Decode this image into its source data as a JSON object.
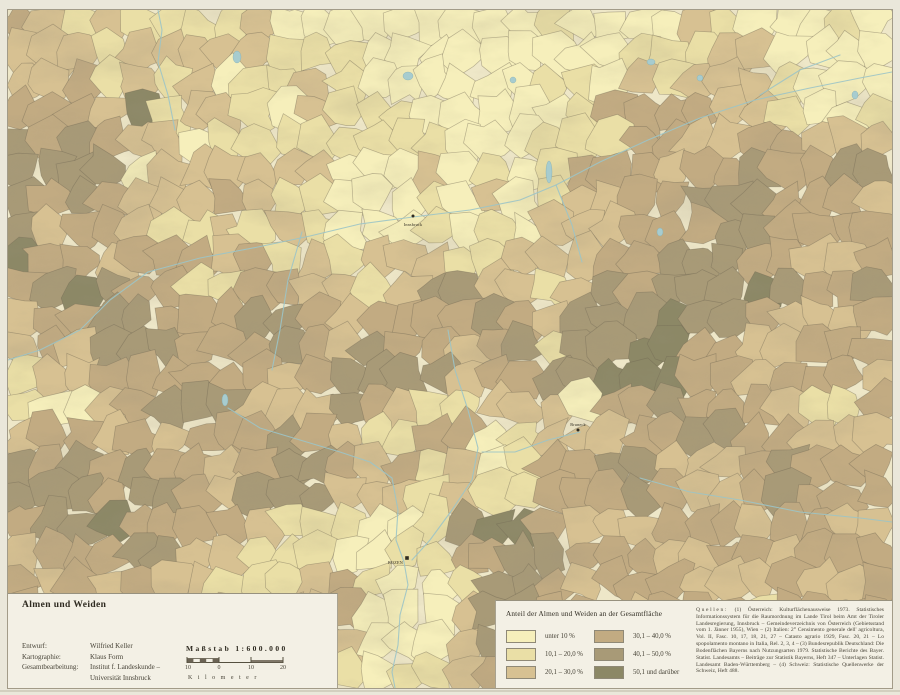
{
  "page": {
    "title": "Almen und Weiden"
  },
  "panel_left": {
    "title": "Almen und Weiden",
    "credits": [
      {
        "label": "Entwurf:",
        "value": "Wilfried Keller"
      },
      {
        "label": "Kartographie:",
        "value": "Klaus Form"
      },
      {
        "label": "Gesamtbearbeitung:",
        "value": "Institut f. Landeskunde –"
      },
      {
        "label": "",
        "value": "Universität Innsbruck"
      }
    ],
    "scale": {
      "label": "Maßstab 1:600.000",
      "ticks": [
        "10",
        "0",
        "10",
        "20"
      ],
      "unit": "Kilometer"
    }
  },
  "legend": {
    "title": "Anteil der Almen und Weiden an der Gesamtfläche",
    "classes": [
      {
        "label": "unter 10 %",
        "color": "#f6efbb"
      },
      {
        "label": "10,1 – 20,0 %",
        "color": "#eadfa6"
      },
      {
        "label": "20,1 – 30,0 %",
        "color": "#d7c192"
      },
      {
        "label": "30,1 – 40,0 %",
        "color": "#c2ab82"
      },
      {
        "label": "40,1 – 50,0 %",
        "color": "#a89a77"
      },
      {
        "label": "50,1 und darüber",
        "color": "#8c8866"
      }
    ]
  },
  "sources": {
    "heading": "Quellen:",
    "text": " (1) Österreich: Kulturflächenausweise 1973. Statistisches Informationssystem für die Raumordnung im Lande Tirol beim Amt der Tiroler Landesregierung, Innsbruck – Gemeindeverzeichnis von Österreich (Gebietsstand vom 1. Jänner 1955), Wien – (2) Italien: 2° Censimento generale dell' agricoltura, Vol. II, Fasc. 10, 17, 18, 21, 27 – Catasto agrario 1929, Fasc. 20, 21 – Lo spopolamento montano in Italia, Rel. 2, 3, 4 – (3) Bundesrepublik Deutschland: Die Bodenflächen Bayerns nach Nutzungsarten 1979. Statistische Berichte des Bayer. Statist. Landesamts – Beiträge zur Statistik Bayerns, Heft 347 – Unterlagen Statist. Landesamt Baden-Württemberg – (4) Schweiz: Statistische Quellenwerke der Schweiz, Heft 488."
  },
  "map": {
    "width": 884,
    "height": 678,
    "background": "#eee7c8",
    "border_color": "#6e6753",
    "river_color": "#9cc4c6",
    "lake_color": "#a7cccf",
    "seed": 42,
    "grid": {
      "cols": 30,
      "rows": 23
    },
    "class_raster": [
      "3232223111111111121111",
      "3323322221111112233111",
      "4436332222111124443212",
      "4443133222211224434433",
      "5541333211312234445445",
      "5443322211111234455444",
      "5434433323322334554434",
      "4554334333443234555445",
      "3455445434444345654334",
      "2344434465434456643443",
      "3234543354323414544324",
      "4433445432441334454433",
      "5545434543232445434544",
      "4554443321256433443433",
      "3445332211245444334344",
      "4434322341125434433443",
      "3443332331135433443344",
      "4344323221234344334434"
    ],
    "rivers": [
      {
        "name": "inn",
        "points": [
          [
            0,
            350
          ],
          [
            32,
            340
          ],
          [
            72,
            320
          ],
          [
            102,
            290
          ],
          [
            140,
            262
          ],
          [
            192,
            248
          ],
          [
            250,
            237
          ],
          [
            302,
            226
          ],
          [
            352,
            214
          ],
          [
            405,
            207
          ],
          [
            462,
            200
          ],
          [
            512,
            190
          ],
          [
            548,
            175
          ],
          [
            592,
            152
          ],
          [
            640,
            130
          ],
          [
            692,
            108
          ],
          [
            747,
            90
          ],
          [
            802,
            78
          ],
          [
            852,
            68
          ],
          [
            884,
            62
          ]
        ]
      },
      {
        "name": "lech",
        "points": [
          [
            167,
            120
          ],
          [
            160,
            85
          ],
          [
            150,
            52
          ],
          [
            154,
            20
          ],
          [
            150,
            0
          ]
        ]
      },
      {
        "name": "ziller",
        "points": [
          [
            548,
            175
          ],
          [
            564,
            215
          ],
          [
            574,
            252
          ]
        ]
      },
      {
        "name": "oetztaler-ache",
        "points": [
          [
            294,
            222
          ],
          [
            280,
            270
          ],
          [
            272,
            320
          ],
          [
            264,
            360
          ]
        ]
      },
      {
        "name": "etsch",
        "points": [
          [
            220,
            398
          ],
          [
            252,
            418
          ],
          [
            292,
            430
          ],
          [
            332,
            442
          ],
          [
            362,
            452
          ],
          [
            384,
            468
          ],
          [
            390,
            500
          ],
          [
            388,
            530
          ],
          [
            396,
            552
          ],
          [
            400,
            575
          ],
          [
            392,
            605
          ],
          [
            390,
            635
          ],
          [
            384,
            662
          ],
          [
            387,
            678
          ]
        ]
      },
      {
        "name": "eisack",
        "points": [
          [
            440,
            320
          ],
          [
            447,
            360
          ],
          [
            460,
            400
          ],
          [
            470,
            438
          ],
          [
            464,
            470
          ],
          [
            444,
            500
          ],
          [
            422,
            530
          ],
          [
            404,
            550
          ]
        ]
      },
      {
        "name": "rienz",
        "points": [
          [
            572,
            422
          ],
          [
            540,
            430
          ],
          [
            507,
            442
          ],
          [
            474,
            442
          ]
        ]
      },
      {
        "name": "drau",
        "points": [
          [
            632,
            468
          ],
          [
            682,
            482
          ],
          [
            732,
            490
          ],
          [
            792,
            502
          ],
          [
            852,
            508
          ],
          [
            884,
            512
          ]
        ]
      },
      {
        "name": "salzach",
        "points": [
          [
            752,
            85
          ],
          [
            792,
            60
          ],
          [
            832,
            45
          ]
        ]
      }
    ],
    "lakes": [
      {
        "cx": 229,
        "cy": 47,
        "rx": 4,
        "ry": 6
      },
      {
        "cx": 400,
        "cy": 66,
        "rx": 5,
        "ry": 4
      },
      {
        "cx": 505,
        "cy": 70,
        "rx": 3,
        "ry": 3
      },
      {
        "cx": 643,
        "cy": 52,
        "rx": 4,
        "ry": 3
      },
      {
        "cx": 692,
        "cy": 68,
        "rx": 3,
        "ry": 3
      },
      {
        "cx": 541,
        "cy": 162,
        "rx": 3,
        "ry": 11
      },
      {
        "cx": 652,
        "cy": 222,
        "rx": 3,
        "ry": 4
      },
      {
        "cx": 847,
        "cy": 85,
        "rx": 3,
        "ry": 4
      },
      {
        "cx": 217,
        "cy": 390,
        "rx": 3,
        "ry": 6
      }
    ],
    "cities": [
      {
        "name": "Innsbruck",
        "x": 405,
        "y": 206,
        "marker": "dot",
        "label_dx": 0,
        "label_dy": 10,
        "anchor": "middle"
      },
      {
        "name": "BOZEN",
        "x": 399,
        "y": 548,
        "marker": "square",
        "label_dx": -4,
        "label_dy": 6,
        "anchor": "end"
      },
      {
        "name": "Bruneck",
        "x": 570,
        "y": 420,
        "marker": "dot",
        "label_dx": 0,
        "label_dy": -4,
        "anchor": "middle"
      }
    ]
  }
}
